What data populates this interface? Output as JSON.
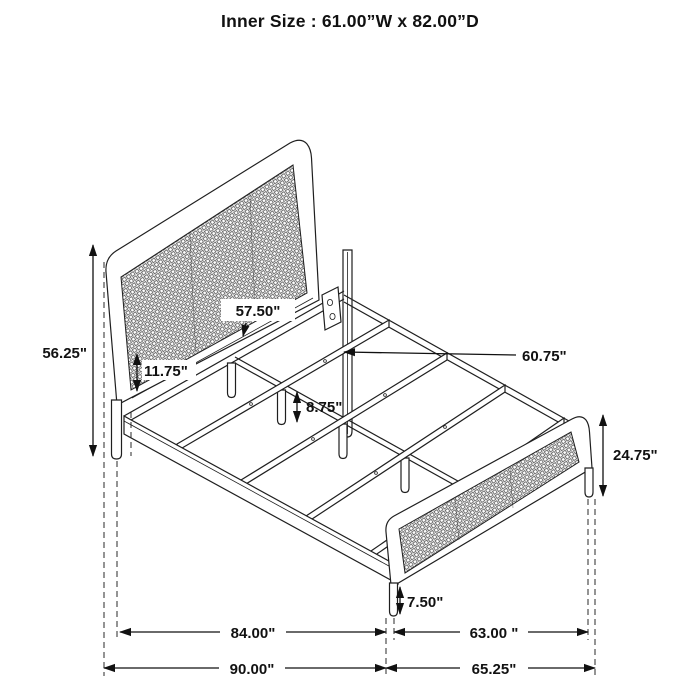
{
  "title": "Inner Size : 61.00”W x 82.00”D",
  "colors": {
    "ink": "#1a1a1a",
    "background": "#ffffff"
  },
  "dimensions": {
    "headboard_height": "56.25\"",
    "inner_width": "57.50\"",
    "rail_height": "11.75\"",
    "slat_length": "60.75\"",
    "support_leg_height": "8.75\"",
    "footboard_height": "24.75\"",
    "footboard_leg_height": "7.50\"",
    "frame_length": "84.00\"",
    "frame_width": "63.00 \"",
    "overall_length": "90.00\"",
    "overall_width": "65.25\""
  }
}
